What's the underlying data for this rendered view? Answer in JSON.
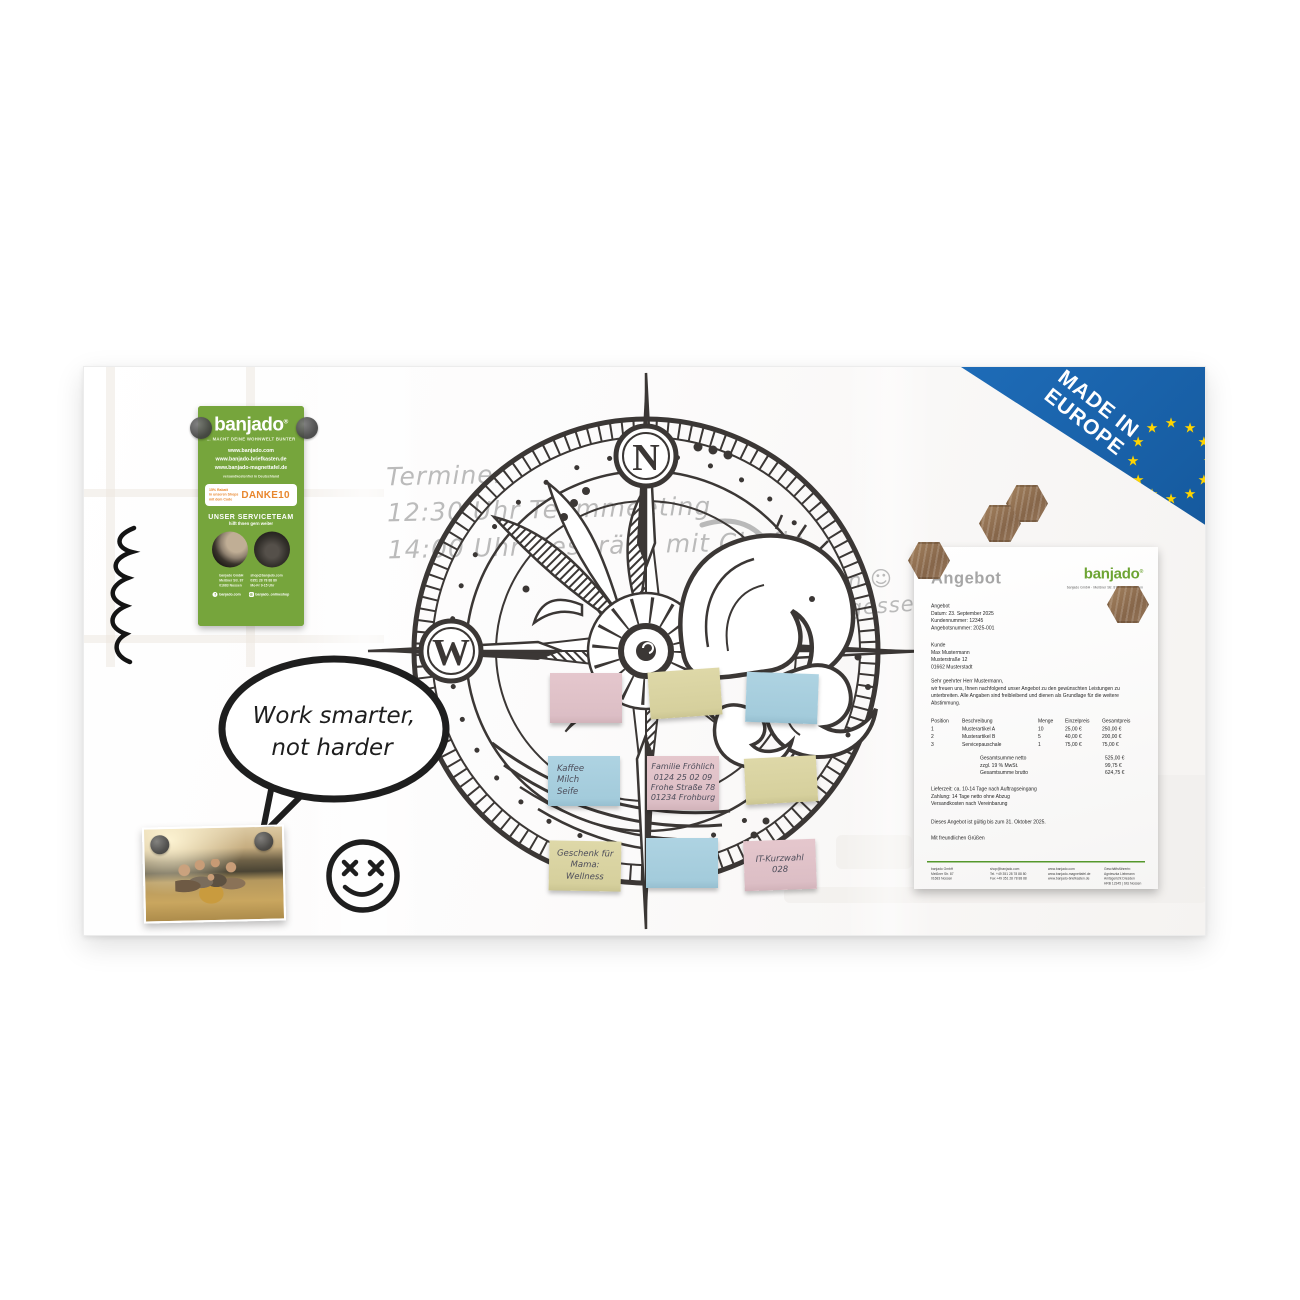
{
  "board": {
    "flyer": {
      "logo": "banjado",
      "logo_reg": "®",
      "tagline": "… MACHT DEINE WOHNWELT BUNTER",
      "urls": [
        "www.banjado.com",
        "www.banjado-briefkasten.de",
        "www.banjado-magnettafel.de"
      ],
      "shipping_note": "versandkostenfrei in Deutschland",
      "discount_lines": [
        "15% Rabatt",
        "in unseren Shops",
        "mit dem Code"
      ],
      "discount_code": "DANKE10",
      "service_title": "UNSER SERVICETEAM",
      "service_sub": "hilft Ihnen gern weiter",
      "footer_left": [
        "banjado GmbH",
        "Meißner Str. 87",
        "01683 Nossen"
      ],
      "footer_right": [
        "shop@banjado.com",
        "0351 28 78 88 80",
        "Mo-Fr 9-15 Uhr"
      ],
      "social_facebook": "banjado.com",
      "social_instagram": "banjado_onlineshop",
      "facebook_glyph": "f",
      "instagram_glyph": "◎"
    },
    "handwriting": {
      "appointments": [
        "Termine:",
        "12:30 Uhr Teammeeting",
        "14:00 Uhr Gespräch mit Chefin"
      ],
      "cake_note": [
        "Kuchen ☺",
        "nicht vergessen"
      ]
    },
    "speech_bubble": [
      "Work smarter,",
      "not harder"
    ],
    "compass": {
      "north": "N",
      "west": "W"
    },
    "made_in_europe": {
      "line1": "MADE IN",
      "line2": "EUROPE",
      "star_glyph": "★"
    },
    "notes": [
      {
        "color": "pink",
        "lines": []
      },
      {
        "color": "khaki",
        "lines": []
      },
      {
        "color": "blue",
        "lines": []
      },
      {
        "color": "blue",
        "lines": [
          "Kaffee",
          "Milch",
          "Seife"
        ]
      },
      {
        "color": "pink",
        "lines": [
          "Familie Fröhlich",
          "0124 25 02 09",
          "Frohe Straße 78",
          "01234 Frohburg"
        ]
      },
      {
        "color": "khaki",
        "lines": []
      },
      {
        "color": "khaki",
        "lines": [
          "Geschenk für",
          "Mama:",
          "Wellness"
        ]
      },
      {
        "color": "blue",
        "lines": []
      },
      {
        "color": "pink",
        "lines": [
          "IT-Kurzwahl",
          "028"
        ]
      }
    ],
    "document": {
      "title": "Angebot",
      "logo": "banjado",
      "logo_reg": "®",
      "logo_sub": "banjado GmbH · Meißner Str. 87 · 01683 Nossen",
      "meta": [
        "Angebot",
        "Datum: 23. September 2025",
        "Kundennummer: 12345",
        "Angebotsnummer: 2025-001"
      ],
      "customer": [
        "Kunde",
        "Max Mustermann",
        "Musterstraße 12",
        "01662 Musterstadt"
      ],
      "salutation": "Sehr geehrter Herr Mustermann,",
      "intro": "wir freuen uns, Ihnen nachfolgend unser Angebot zu den gewünschten Leistungen zu unterbreiten. Alle Angaben sind freibleibend und dienen als Grundlage für die weitere Abstimmung.",
      "table": {
        "headers": [
          "Position",
          "Beschreibung",
          "Menge",
          "Einzelpreis",
          "Gesamtpreis"
        ],
        "rows": [
          [
            "1",
            "Musterartikel A",
            "10",
            "25,00 €",
            "250,00 €"
          ],
          [
            "2",
            "Musterartikel B",
            "5",
            "40,00 €",
            "200,00 €"
          ],
          [
            "3",
            "Servicepauschale",
            "1",
            "75,00 €",
            "75,00 €"
          ]
        ],
        "totals": [
          [
            "Gesamtsumme netto",
            "525,00 €"
          ],
          [
            "zzgl. 19 % MwSt.",
            "99,75 €"
          ],
          [
            "Gesamtsumme brutto",
            "624,75 €"
          ]
        ]
      },
      "terms": [
        "Lieferzeit: ca. 10-14 Tage nach Auftragseingang",
        "Zahlung: 14 Tage netto ohne Abzug",
        "Versandkosten nach Vereinbarung"
      ],
      "validity": "Dieses Angebot ist gültig bis zum 31. Oktober 2025.",
      "closing": "Mit freundlichen Grüßen",
      "footer_cols": [
        [
          "banjado GmbH",
          "Meißner Str. 87",
          "01683 Nossen"
        ],
        [
          "shop@banjado.com",
          "Tel. +49 351 28 78 88 80",
          "Fax +49 351 28 78 88 88"
        ],
        [
          "www.banjado.com",
          "www.banjado-magnettafel.de",
          "www.banjado-briefkasten.de"
        ],
        [
          "Geschäftsführerin: Agnieszka Liebmann",
          "Amtsgericht Dresden",
          "HRB 12345 | Sitz Nossen"
        ]
      ]
    },
    "colors": {
      "flyer_green": "#76a53c",
      "logo_green": "#6da433",
      "accent_orange": "#e8872e",
      "badge_blue": "#1a64b0",
      "star_yellow": "#ffd400",
      "note_pink": "#e0c3c9",
      "note_khaki": "#d9d3a0",
      "note_blue": "#a7cedd",
      "ink": "#3b3735",
      "marker_gray": "#ababab",
      "doc_rule_green": "#55982c",
      "wood": "#97775a"
    }
  }
}
